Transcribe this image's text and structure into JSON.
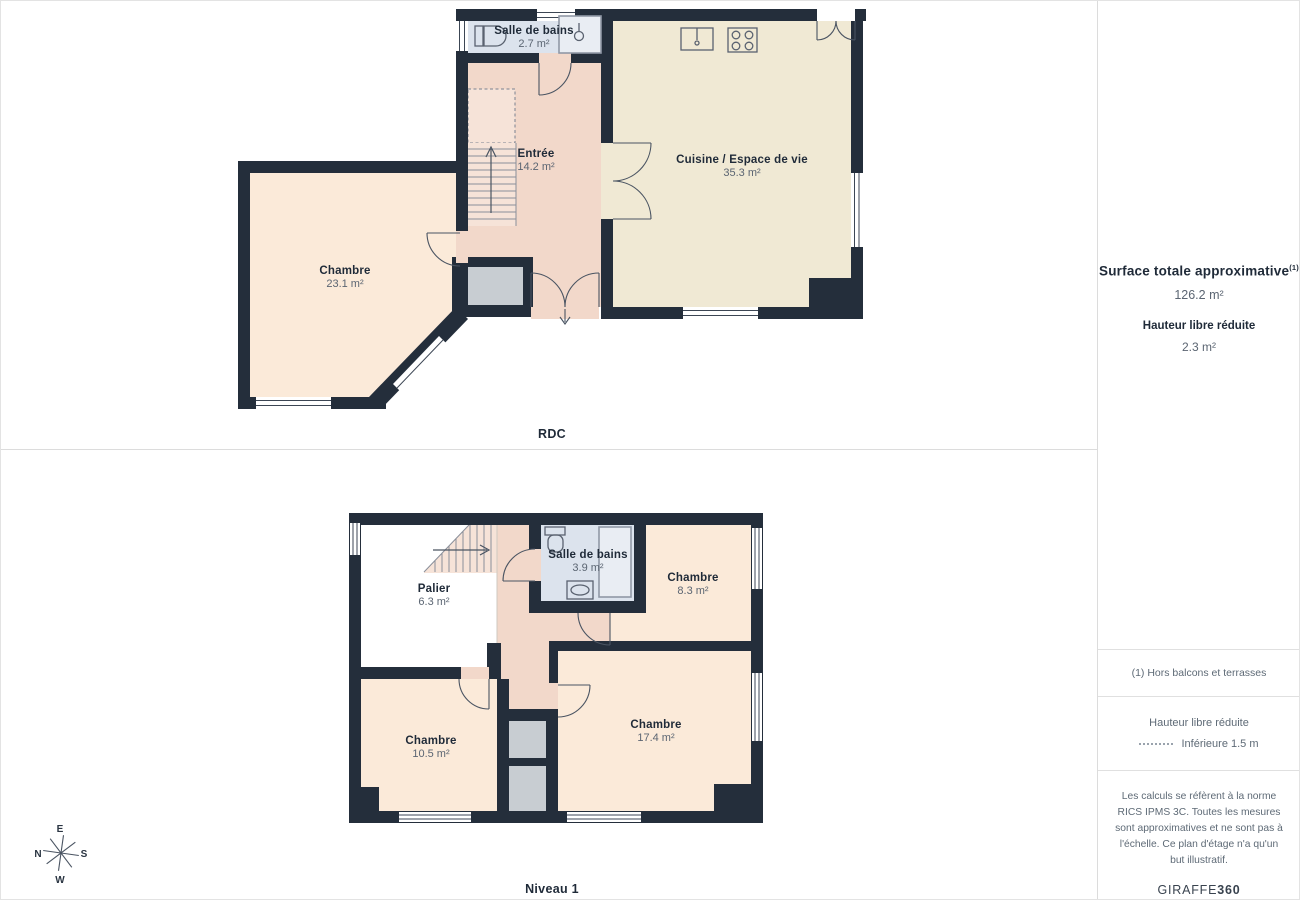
{
  "floors": {
    "rdc": {
      "title": "RDC",
      "rooms": {
        "bathroom": {
          "name": "Salle de bains",
          "area": "2.7 m²"
        },
        "entry": {
          "name": "Entrée",
          "area": "14.2 m²"
        },
        "kitchen": {
          "name": "Cuisine / Espace de vie",
          "area": "35.3 m²"
        },
        "bedroom": {
          "name": "Chambre",
          "area": "23.1 m²"
        }
      }
    },
    "niveau1": {
      "title": "Niveau 1",
      "rooms": {
        "landing": {
          "name": "Palier",
          "area": "6.3 m²"
        },
        "bathroom": {
          "name": "Salle de bains",
          "area": "3.9 m²"
        },
        "bedroom_small": {
          "name": "Chambre",
          "area": "8.3 m²"
        },
        "bedroom_medium": {
          "name": "Chambre",
          "area": "10.5 m²"
        },
        "bedroom_large": {
          "name": "Chambre",
          "area": "17.4 m²"
        }
      }
    }
  },
  "sidebar": {
    "surface_title": "Surface totale approximative",
    "surface_sup": "(1)",
    "surface_value": "126.2 m²",
    "height_title": "Hauteur libre réduite",
    "height_value": "2.3 m²",
    "note": "(1) Hors balcons et terrasses",
    "legend_title": "Hauteur libre réduite",
    "legend_value": "Inférieure 1.5 m",
    "disclaimer": "Les calculs se réfèrent à la norme RICS IPMS 3C. Toutes les mesures sont approximatives et ne sont pas à l'échelle. Ce plan d'étage n'a qu'un but illustratif.",
    "brand_name": "GIRAFFE",
    "brand_suffix": "360"
  },
  "compass": {
    "east": "E",
    "north": "N",
    "south": "S",
    "west": "W"
  },
  "colors": {
    "wall": "#242e3b",
    "room_pink": "#f2d8ca",
    "room_pink_light": "#f6e3d8",
    "room_beige": "#f0e9d4",
    "room_peach": "#fbead9",
    "room_blue": "#dce3ed",
    "closet_gray": "#c8cdd2",
    "line": "#4a5462"
  }
}
